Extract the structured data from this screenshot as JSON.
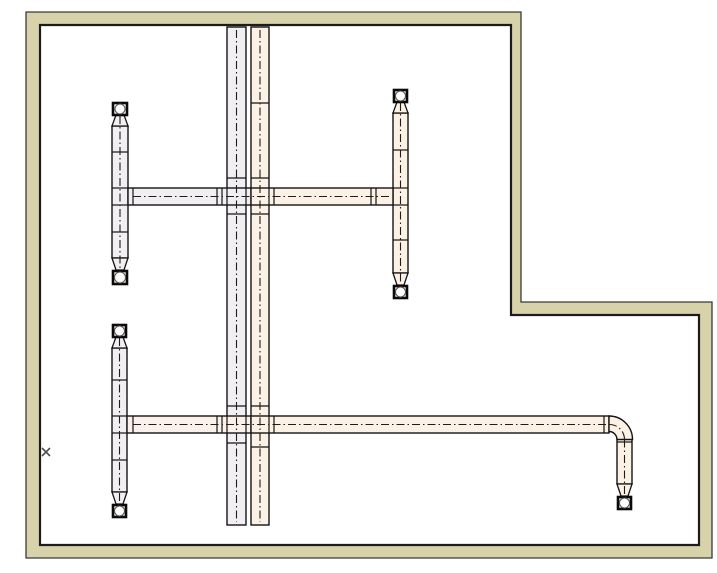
{
  "meta": {
    "width": 717,
    "height": 573,
    "background": "#ffffff",
    "app_hint": "cad-piping-plan"
  },
  "colors": {
    "wall_fill": "#d8d2ab",
    "wall_edge_outer": "#3a3a38",
    "wall_edge_inner": "#1c1c1c",
    "pipe_outline": "#141414",
    "pipe_fill_gray": "#f1eff2",
    "pipe_fill_peach": "#fcf1e5",
    "pipe_fill_warm": "#f9f1ea",
    "centerline": "#201c1a",
    "tick": "#141414",
    "valve_border": "#0a0a0a",
    "valve_fill": "#fdfdfd",
    "valve_circle_stroke": "#55504c",
    "cursor_mark": "#4f4f4f"
  },
  "walls": {
    "outer": [
      [
        26,
        12
      ],
      [
        521,
        12
      ],
      [
        521,
        302
      ],
      [
        712,
        302
      ],
      [
        712,
        558
      ],
      [
        26,
        558
      ]
    ],
    "inner": [
      [
        40,
        25
      ],
      [
        511,
        25
      ],
      [
        511,
        315
      ],
      [
        699,
        315
      ],
      [
        699,
        545
      ],
      [
        40,
        545
      ]
    ]
  },
  "pipes": [
    {
      "name": "main-riser-left",
      "x": 227,
      "y": 27,
      "w": 19,
      "h": 498,
      "fill": "gray"
    },
    {
      "name": "main-riser-right",
      "x": 251,
      "y": 27,
      "w": 18,
      "h": 498,
      "fill": "peach"
    },
    {
      "name": "radiator-riser-upper-left",
      "x": 112,
      "y": 126,
      "w": 16,
      "h": 132,
      "fill": "gray"
    },
    {
      "name": "radiator-riser-upper-right",
      "x": 393,
      "y": 113,
      "w": 15,
      "h": 160,
      "fill": "peach"
    },
    {
      "name": "radiator-riser-lower-left",
      "x": 112,
      "y": 348,
      "w": 15,
      "h": 144,
      "fill": "gray"
    },
    {
      "name": "branch-upper-left-segment",
      "x": 128,
      "y": 188,
      "w": 123,
      "h": 17,
      "fill": "gray"
    },
    {
      "name": "branch-upper-right-segment",
      "x": 251,
      "y": 188,
      "w": 142,
      "h": 17,
      "fill": "peach"
    },
    {
      "name": "branch-lower-left-segment",
      "x": 127,
      "y": 416,
      "w": 124,
      "h": 17,
      "fill": "warm"
    },
    {
      "name": "branch-lower-right-segment",
      "x": 251,
      "y": 416,
      "w": 358,
      "h": 17,
      "fill": "peach"
    },
    {
      "name": "end-drop-pipe",
      "x": 617,
      "y": 439,
      "w": 15,
      "h": 45,
      "fill": "peach"
    }
  ],
  "elbow": {
    "name": "elbow-bottom-right",
    "path": "M 609 416 A 23.5 23.5 0 0 1 632.5 439.5 L 617 439.5 A 8 8 0 0 0 609 431.5 Z",
    "fill": "peach"
  },
  "centerlines": [
    {
      "name": "centerline-main-left",
      "type": "line",
      "x1": 236.5,
      "y1": 30,
      "x2": 236.5,
      "y2": 522
    },
    {
      "name": "centerline-main-right",
      "type": "line",
      "x1": 260,
      "y1": 30,
      "x2": 260,
      "y2": 522
    },
    {
      "name": "centerline-branch-upper",
      "type": "line",
      "x1": 133,
      "y1": 196.5,
      "x2": 390,
      "y2": 196.5
    },
    {
      "name": "centerline-branch-lower",
      "type": "line",
      "x1": 133,
      "y1": 424.5,
      "x2": 609,
      "y2": 424.5
    },
    {
      "name": "centerline-elbow",
      "type": "path",
      "d": "M 609 424.5 A 15 15 0 0 1 624.5 439.5"
    },
    {
      "name": "centerline-end-drop",
      "type": "line",
      "x1": 624.5,
      "y1": 439.5,
      "x2": 624.5,
      "y2": 494
    },
    {
      "name": "centerline-riser-upper-left",
      "type": "line",
      "x1": 120,
      "y1": 116,
      "x2": 120,
      "y2": 269
    },
    {
      "name": "centerline-riser-upper-right",
      "type": "line",
      "x1": 400.5,
      "y1": 103,
      "x2": 400.5,
      "y2": 284
    },
    {
      "name": "centerline-riser-lower-left",
      "type": "line",
      "x1": 119.5,
      "y1": 338,
      "x2": 119.5,
      "y2": 503
    }
  ],
  "ticks": [
    {
      "name": "coupling",
      "x1": 133,
      "y1": 188,
      "x2": 133,
      "y2": 205
    },
    {
      "name": "coupling",
      "x1": 217,
      "y1": 188,
      "x2": 217,
      "y2": 205
    },
    {
      "name": "coupling",
      "x1": 222,
      "y1": 188,
      "x2": 222,
      "y2": 205
    },
    {
      "name": "coupling",
      "x1": 227,
      "y1": 188,
      "x2": 227,
      "y2": 205
    },
    {
      "name": "coupling",
      "x1": 246,
      "y1": 188,
      "x2": 246,
      "y2": 205
    },
    {
      "name": "coupling",
      "x1": 269,
      "y1": 188,
      "x2": 269,
      "y2": 205
    },
    {
      "name": "coupling",
      "x1": 274,
      "y1": 188,
      "x2": 274,
      "y2": 205
    },
    {
      "name": "coupling",
      "x1": 371,
      "y1": 188,
      "x2": 371,
      "y2": 205
    },
    {
      "name": "coupling",
      "x1": 376,
      "y1": 188,
      "x2": 376,
      "y2": 205
    },
    {
      "name": "coupling",
      "x1": 133,
      "y1": 416,
      "x2": 133,
      "y2": 433
    },
    {
      "name": "coupling",
      "x1": 217,
      "y1": 416,
      "x2": 217,
      "y2": 433
    },
    {
      "name": "coupling",
      "x1": 222,
      "y1": 416,
      "x2": 222,
      "y2": 433
    },
    {
      "name": "coupling",
      "x1": 227,
      "y1": 416,
      "x2": 227,
      "y2": 433
    },
    {
      "name": "coupling",
      "x1": 246,
      "y1": 416,
      "x2": 246,
      "y2": 433
    },
    {
      "name": "coupling",
      "x1": 269,
      "y1": 416,
      "x2": 269,
      "y2": 433
    },
    {
      "name": "coupling",
      "x1": 274,
      "y1": 416,
      "x2": 274,
      "y2": 433
    },
    {
      "name": "coupling",
      "x1": 604,
      "y1": 416,
      "x2": 604,
      "y2": 433
    },
    {
      "name": "pipe-joint",
      "x1": 251,
      "y1": 103,
      "x2": 269,
      "y2": 103
    },
    {
      "name": "pipe-joint",
      "x1": 251,
      "y1": 447,
      "x2": 269,
      "y2": 447
    },
    {
      "name": "pipe-joint",
      "x1": 227,
      "y1": 178,
      "x2": 246,
      "y2": 178
    },
    {
      "name": "pipe-joint",
      "x1": 227,
      "y1": 214,
      "x2": 246,
      "y2": 214
    },
    {
      "name": "pipe-joint",
      "x1": 251,
      "y1": 178,
      "x2": 269,
      "y2": 178
    },
    {
      "name": "pipe-joint",
      "x1": 251,
      "y1": 214,
      "x2": 269,
      "y2": 214
    },
    {
      "name": "pipe-joint",
      "x1": 227,
      "y1": 406,
      "x2": 246,
      "y2": 406
    },
    {
      "name": "pipe-joint",
      "x1": 227,
      "y1": 443,
      "x2": 246,
      "y2": 443
    },
    {
      "name": "pipe-joint",
      "x1": 251,
      "y1": 406,
      "x2": 269,
      "y2": 406
    },
    {
      "name": "pipe-joint",
      "x1": 112,
      "y1": 152,
      "x2": 128,
      "y2": 152
    },
    {
      "name": "pipe-joint",
      "x1": 112,
      "y1": 188,
      "x2": 128,
      "y2": 188
    },
    {
      "name": "pipe-joint",
      "x1": 112,
      "y1": 205,
      "x2": 128,
      "y2": 205
    },
    {
      "name": "pipe-joint",
      "x1": 112,
      "y1": 232,
      "x2": 128,
      "y2": 232
    },
    {
      "name": "pipe-joint",
      "x1": 393,
      "y1": 150,
      "x2": 408,
      "y2": 150
    },
    {
      "name": "pipe-joint",
      "x1": 393,
      "y1": 188,
      "x2": 408,
      "y2": 188
    },
    {
      "name": "pipe-joint",
      "x1": 393,
      "y1": 205,
      "x2": 408,
      "y2": 205
    },
    {
      "name": "pipe-joint",
      "x1": 393,
      "y1": 240,
      "x2": 408,
      "y2": 240
    },
    {
      "name": "pipe-joint",
      "x1": 112,
      "y1": 380,
      "x2": 127,
      "y2": 380
    },
    {
      "name": "pipe-joint",
      "x1": 112,
      "y1": 416,
      "x2": 127,
      "y2": 416
    },
    {
      "name": "pipe-joint",
      "x1": 112,
      "y1": 433,
      "x2": 127,
      "y2": 433
    },
    {
      "name": "pipe-joint",
      "x1": 112,
      "y1": 460,
      "x2": 127,
      "y2": 460
    },
    {
      "name": "pipe-joint",
      "x1": 617,
      "y1": 442,
      "x2": 632,
      "y2": 442
    }
  ],
  "tapers": [
    {
      "name": "reducer-upper-left-top",
      "fill": "gray",
      "points": [
        [
          116,
          115
        ],
        [
          124,
          115
        ],
        [
          128,
          126
        ],
        [
          112,
          126
        ]
      ]
    },
    {
      "name": "reducer-upper-left-bottom",
      "fill": "gray",
      "points": [
        [
          112,
          258
        ],
        [
          128,
          258
        ],
        [
          124,
          270
        ],
        [
          116,
          270
        ]
      ]
    },
    {
      "name": "reducer-upper-right-top",
      "fill": "peach",
      "points": [
        [
          397,
          102
        ],
        [
          404,
          102
        ],
        [
          408,
          113
        ],
        [
          393,
          113
        ]
      ]
    },
    {
      "name": "reducer-upper-right-bottom",
      "fill": "peach",
      "points": [
        [
          393,
          273
        ],
        [
          408,
          273
        ],
        [
          404,
          285
        ],
        [
          397,
          285
        ]
      ]
    },
    {
      "name": "reducer-lower-left-top",
      "fill": "gray",
      "points": [
        [
          116,
          337
        ],
        [
          123,
          337
        ],
        [
          127,
          348
        ],
        [
          112,
          348
        ]
      ]
    },
    {
      "name": "reducer-lower-left-bottom",
      "fill": "gray",
      "points": [
        [
          112,
          492
        ],
        [
          127,
          492
        ],
        [
          123,
          504
        ],
        [
          116,
          504
        ]
      ]
    },
    {
      "name": "reducer-end-drop",
      "fill": "peach",
      "points": [
        [
          617,
          484
        ],
        [
          632,
          484
        ],
        [
          628,
          496
        ],
        [
          621,
          496
        ]
      ]
    }
  ],
  "valves": [
    {
      "name": "valve-upper-left-top",
      "x": 113,
      "y": 103,
      "w": 14,
      "h": 12
    },
    {
      "name": "valve-upper-left-bottom",
      "x": 113,
      "y": 271,
      "w": 14,
      "h": 13
    },
    {
      "name": "valve-upper-right-top",
      "x": 394,
      "y": 90,
      "w": 13,
      "h": 12
    },
    {
      "name": "valve-upper-right-bottom",
      "x": 394,
      "y": 286,
      "w": 13,
      "h": 12
    },
    {
      "name": "valve-lower-left-top",
      "x": 113,
      "y": 325,
      "w": 13,
      "h": 12
    },
    {
      "name": "valve-lower-left-bottom",
      "x": 113,
      "y": 505,
      "w": 13,
      "h": 12
    },
    {
      "name": "valve-end-drop",
      "x": 618,
      "y": 497,
      "w": 13,
      "h": 12
    }
  ],
  "cursor_mark": {
    "cx": 46,
    "cy": 452,
    "half": 4
  }
}
